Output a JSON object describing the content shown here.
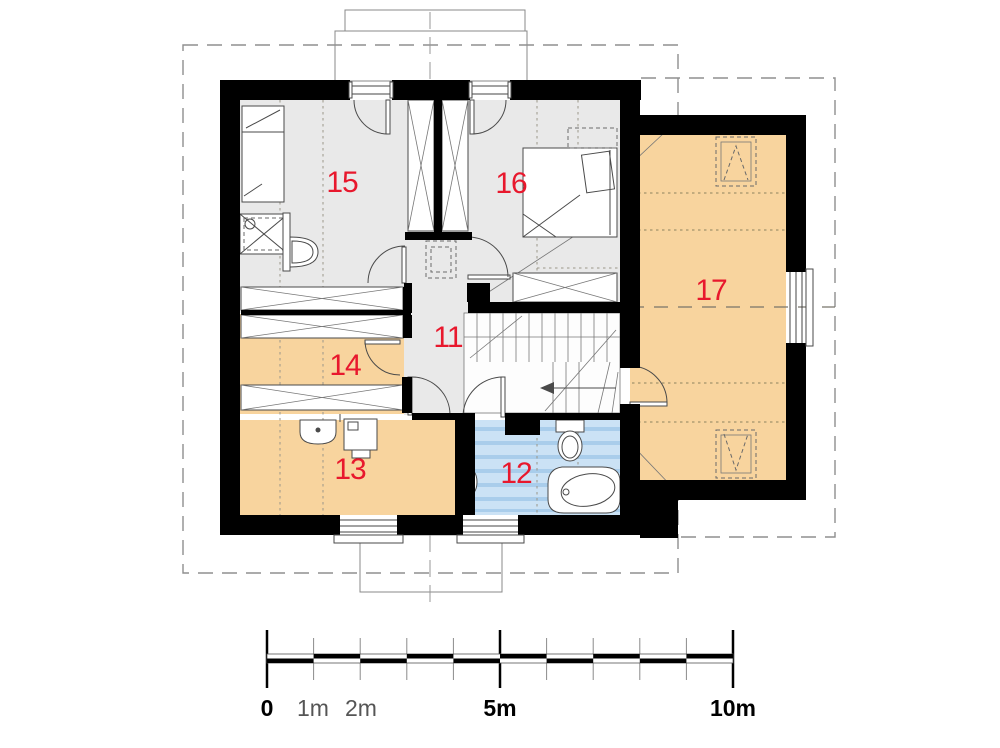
{
  "plan": {
    "kind": "floor-plan",
    "rooms": [
      {
        "number": "11",
        "floor": "gray"
      },
      {
        "number": "12",
        "floor": "blue"
      },
      {
        "number": "13",
        "floor": "orange"
      },
      {
        "number": "14",
        "floor": "orange"
      },
      {
        "number": "15",
        "floor": "gray"
      },
      {
        "number": "16",
        "floor": "gray"
      },
      {
        "number": "17",
        "floor": "orange"
      }
    ]
  },
  "scale_bar": {
    "labels": [
      "0",
      "1m",
      "2m",
      "5m",
      "10m"
    ]
  },
  "colors": {
    "wall": "#000000",
    "floor_gray": "#e9e9e9",
    "floor_orange": "#f8d49e",
    "floor_blue": "#cbe2f5",
    "floor_blue_stripe": "#a9cdeb",
    "label_red": "#e8182d",
    "roof_dash_gray": "#8f8f8f"
  }
}
